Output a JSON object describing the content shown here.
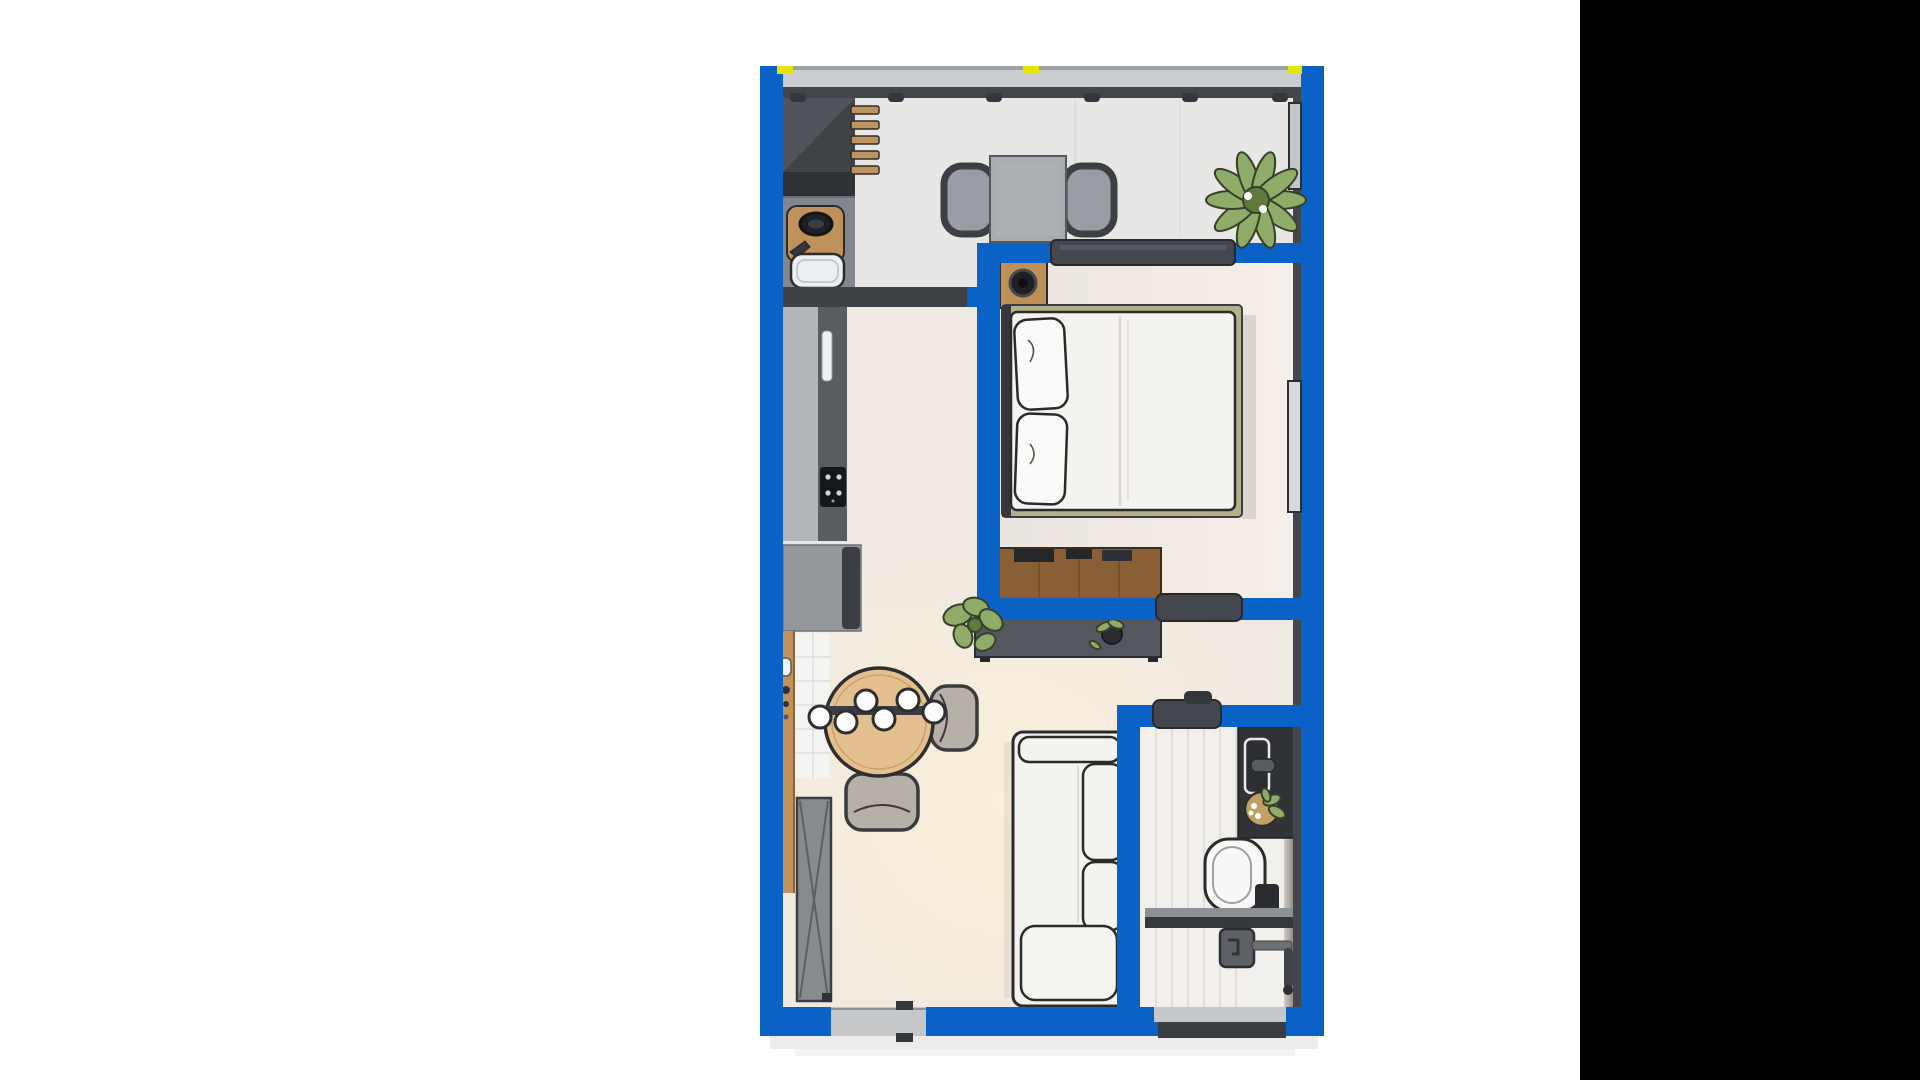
{
  "scene": {
    "type": "floor-plan-render",
    "description": "Top-down 3D rendering of a one-bedroom apartment floor plan with thick blue walls, centered on a white background, with a solid black vertical panel along the right edge of the screenshot",
    "text_visible": ""
  },
  "palette": {
    "background": "#ffffff",
    "panel_black": "#000000",
    "wall_blue": "#0a62c6",
    "wall_dark": "#3e4146",
    "wall_face": "#43464b",
    "floor_base": "#ece7e2",
    "floor_top_room": "#e9e6e6",
    "floor_bath": "#f2f0ed",
    "glazing_gray": "#cbced1",
    "threshold_gray": "#c6c8ca",
    "door_leaf": "#43464c",
    "furniture_dark": "#54575d",
    "counter_light": "#b3b6ba",
    "granite": "#595c61",
    "appliance_gray": "#94979c",
    "cooktop_black": "#15171a",
    "wood_light": "#e4bf90",
    "wood_mid": "#c0935c",
    "wood_dark": "#8a5f35",
    "white_furniture": "#f5f3f0",
    "outline": "#2b2b2b",
    "chair_greige": "#b7b0a9",
    "chair_gray": "#9a9da3",
    "table_gray": "#a8abb0",
    "plant_green": "#8fad68",
    "plant_dark": "#5f7a3e",
    "vanity_black": "#303236",
    "accent_yellow": "#e5e600",
    "shadow": "#e9e9e9"
  },
  "walls": {
    "style": "solid-blue-outline",
    "door_leaf_count": 3,
    "yellow_marker_count": 3,
    "window_count": 4
  },
  "rooms": [
    {
      "name": "kitchen-dining-top",
      "furniture": [
        "tall-kitchen-cabinet",
        "wall-slat-shelf",
        "sink-counter-cutting-board",
        "square-table",
        "two-gray-chairs",
        "large-potted-plant",
        "side-window"
      ]
    },
    {
      "name": "bedroom",
      "furniture": [
        "double-bed-white",
        "two-pillows",
        "wood-nightstand",
        "black-round-lamp",
        "walnut-dresser",
        "side-window",
        "sliding-door"
      ]
    },
    {
      "name": "living-kitchen-corridor",
      "furniture": [
        "counter-run-with-granite",
        "cooktop",
        "refrigerator",
        "wood-wall-shelf",
        "tiled-nook",
        "round-dining-table",
        "pendant-bulb-bar",
        "two-greige-chairs",
        "floor-plant",
        "tv-console",
        "console-plant",
        "white-sofa",
        "entry-door-leaf"
      ]
    },
    {
      "name": "bathroom",
      "furniture": [
        "dark-vanity-with-sink",
        "plant-basket",
        "toilet",
        "glass-divider",
        "shower-fixture",
        "bottom-window"
      ]
    }
  ]
}
